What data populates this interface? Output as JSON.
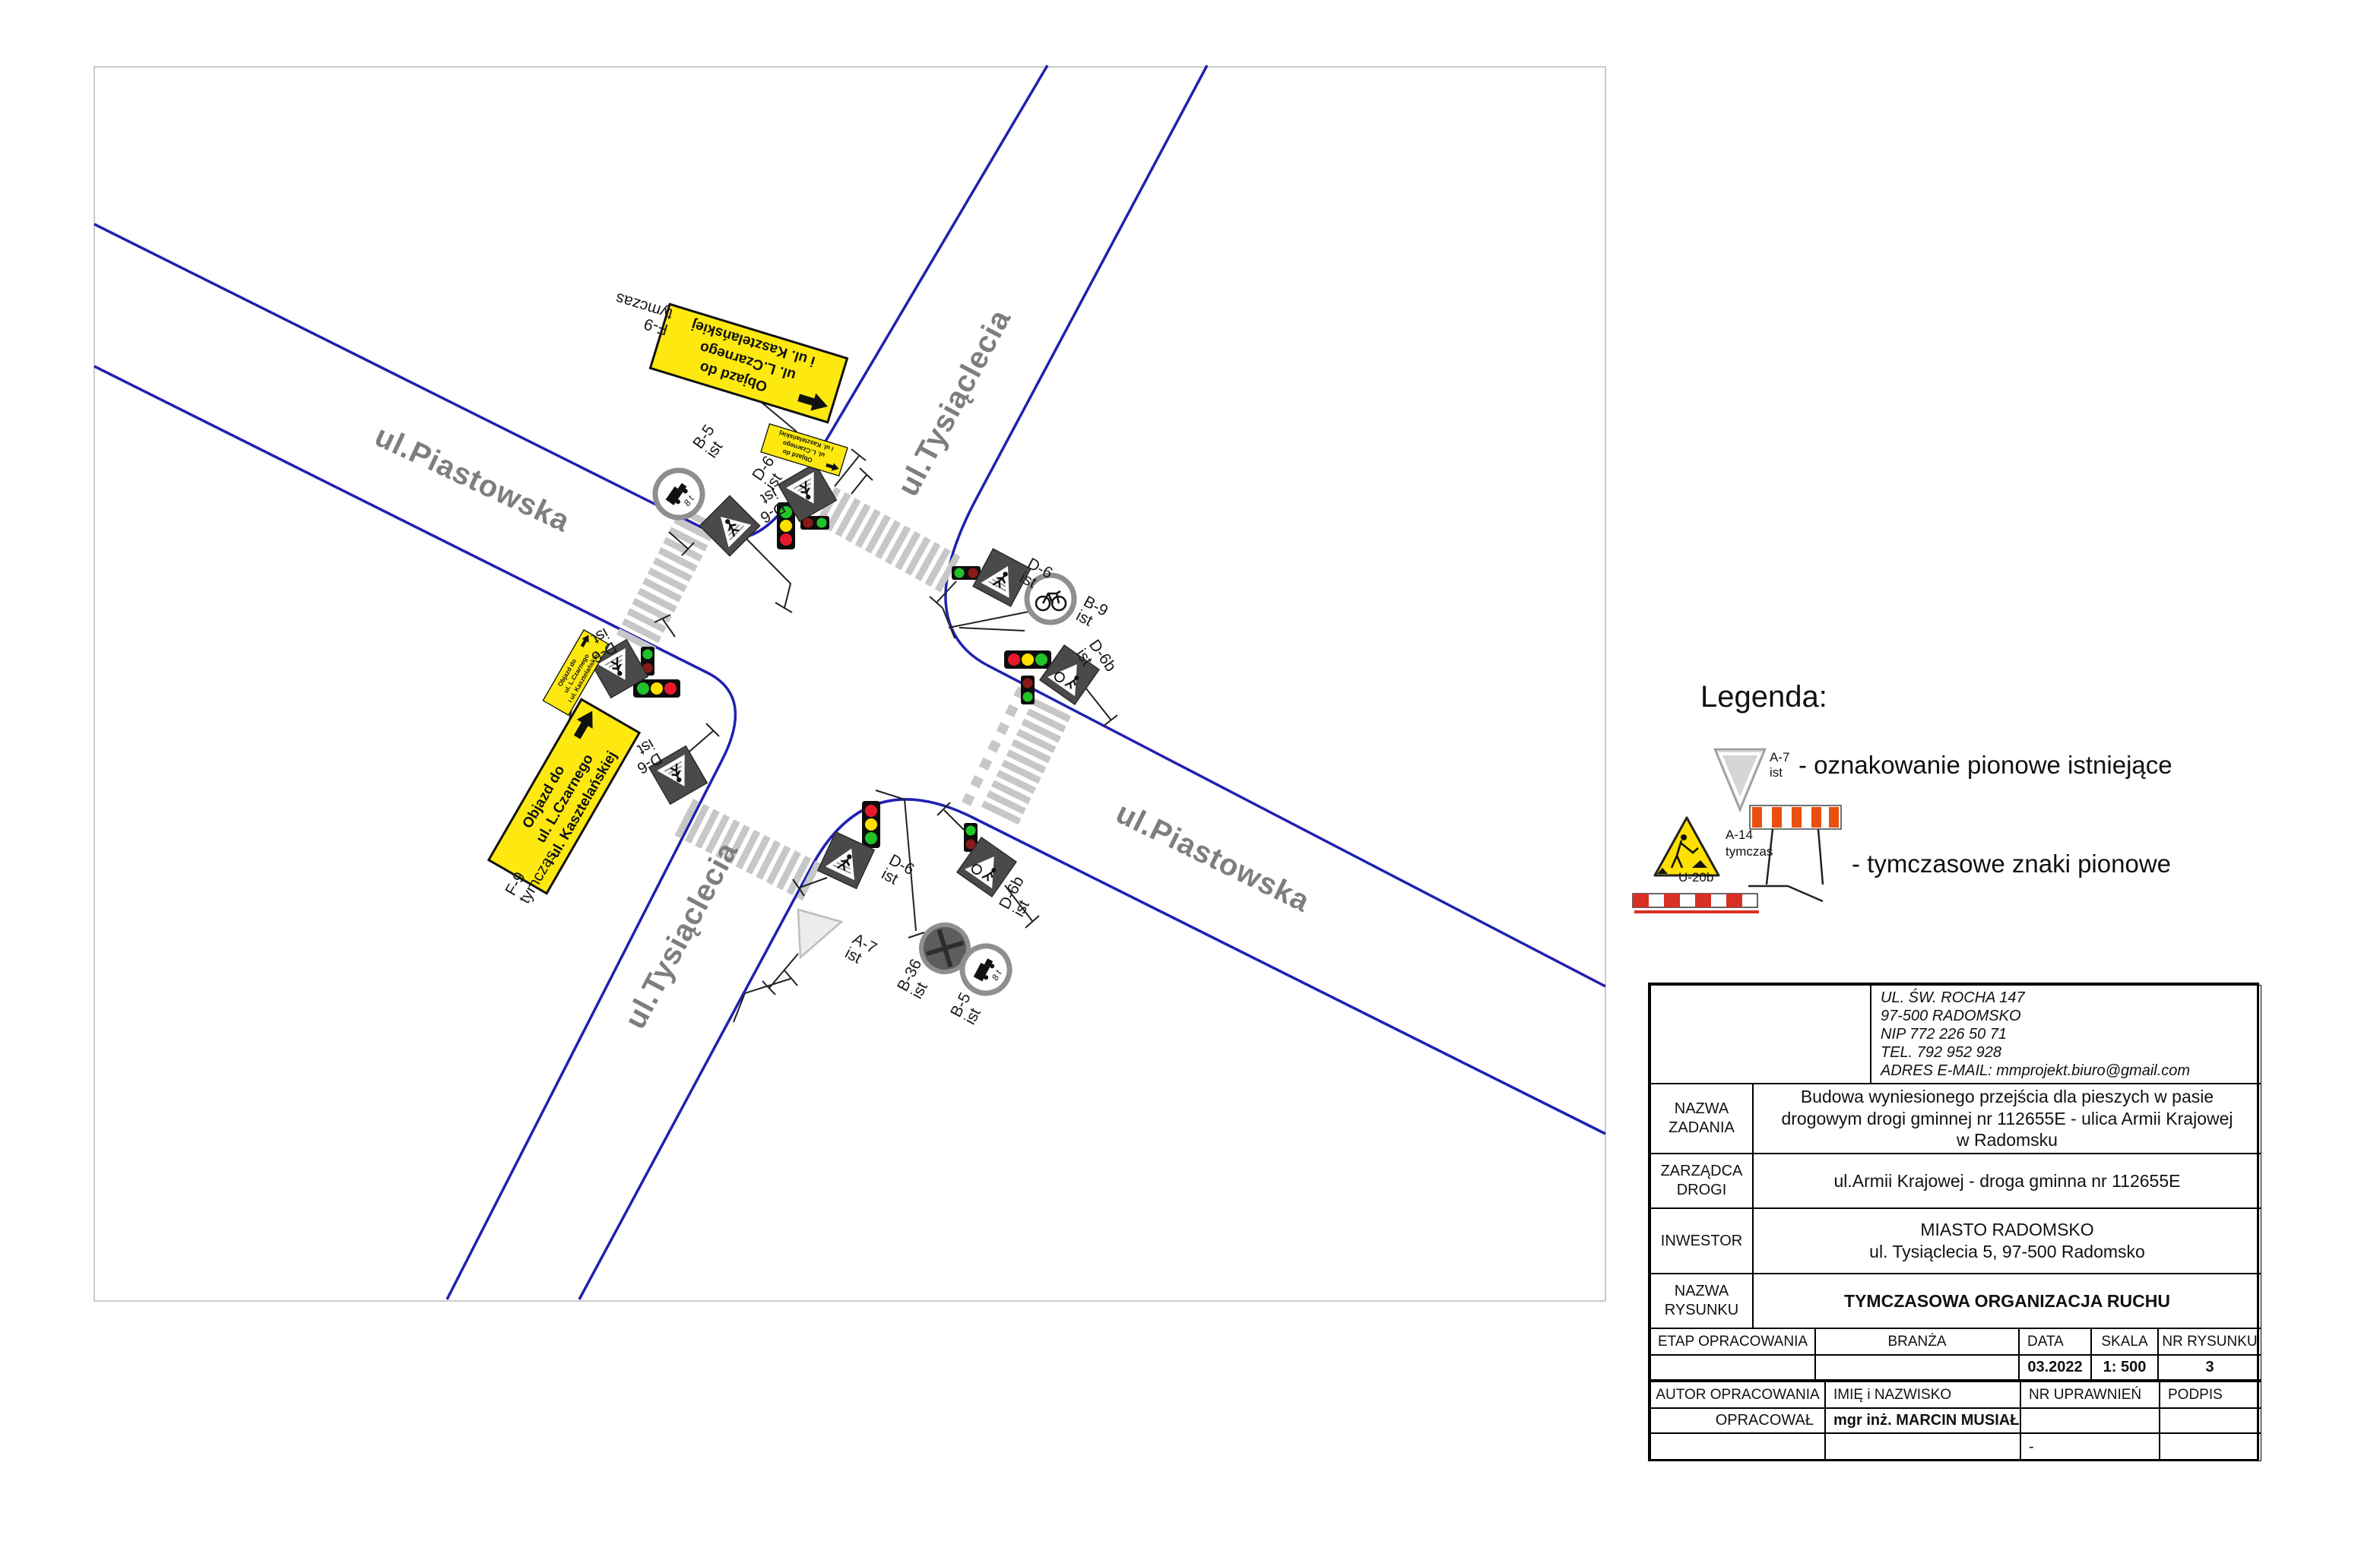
{
  "map": {
    "streets": {
      "piastowska_nw": "ul.Piastowska",
      "tysiaclecia_n": "ul.Tysiąclecia",
      "piastowska_se": "ul.Piastowska",
      "tysiaclecia_s": "ul.Tysiąclecia"
    },
    "detour_board": {
      "code": "F-9",
      "status": "tymczas",
      "line1": "Objazd do",
      "line2": "ul. L.Czarnego",
      "line3": "i ul. Kasztelańskiej"
    },
    "sign_codes": {
      "b5": "B-5",
      "b9": "B-9",
      "b36": "B-36",
      "d6": "D-6",
      "d6b": "D-6b",
      "a7": "A-7",
      "ist": "ist",
      "tymczas": "tymczas",
      "truck_weight": "8 t"
    },
    "colors": {
      "road_edge": "#2021b0",
      "crosswalk": "#c7c7c7",
      "detour_yellow": "#fde910",
      "sign_gray": "#4a4a4a"
    }
  },
  "legend": {
    "title": "Legenda:",
    "existing": {
      "code": "A-7",
      "status": "ist",
      "label": "- oznakowanie pionowe istniejące"
    },
    "temporary": {
      "code": "A-14",
      "status": "tymczas",
      "barrier": "U-20b",
      "label": "- tymczasowe znaki pionowe"
    }
  },
  "title_block": {
    "logo_text": "MM PROJEKT",
    "company_address": [
      "UL. ŚW. ROCHA 147",
      "97-500 RADOMSKO",
      "NIP 772 226 50 71",
      "TEL. 792 952 928",
      "ADRES E-MAIL: mmprojekt.biuro@gmail.com"
    ],
    "nazwa_zadania_label": "NAZWA ZADANIA",
    "nazwa_zadania_value": "Budowa wyniesionego przejścia dla pieszych w pasie drogowym  drogi gminnej nr 112655E - ulica Armii Krajowej w Radomsku",
    "zarzadca_label": "ZARZĄDCA DROGI",
    "zarzadca_value": "ul.Armii Krajowej - droga gminna nr 112655E",
    "inwestor_label": "INWESTOR",
    "inwestor_value_line1": "MIASTO RADOMSKO",
    "inwestor_value_line2": "ul. Tysiąclecia 5, 97-500 Radomsko",
    "nazwa_rysunku_label": "NAZWA RYSUNKU",
    "nazwa_rysunku_value": "TYMCZASOWA ORGANIZACJA RUCHU",
    "etap_label": "ETAP OPRACOWANIA",
    "branza_label": "BRANŻA",
    "data_label": "DATA",
    "data_value": "03.2022",
    "skala_label": "SKALA",
    "skala_value": "1: 500",
    "nr_rysunku_label": "NR RYSUNKU",
    "nr_rysunku_value": "3",
    "autor_label": "AUTOR OPRACOWANIA",
    "imie_label": "IMIĘ i NAZWISKO",
    "nr_uprawnien_label": "NR UPRAWNIEŃ",
    "podpis_label": "PODPIS",
    "opracowal_label": "OPRACOWAŁ",
    "opracowal_value": "mgr inż. MARCIN MUSIAŁ",
    "uprawnienia_value": "-"
  }
}
